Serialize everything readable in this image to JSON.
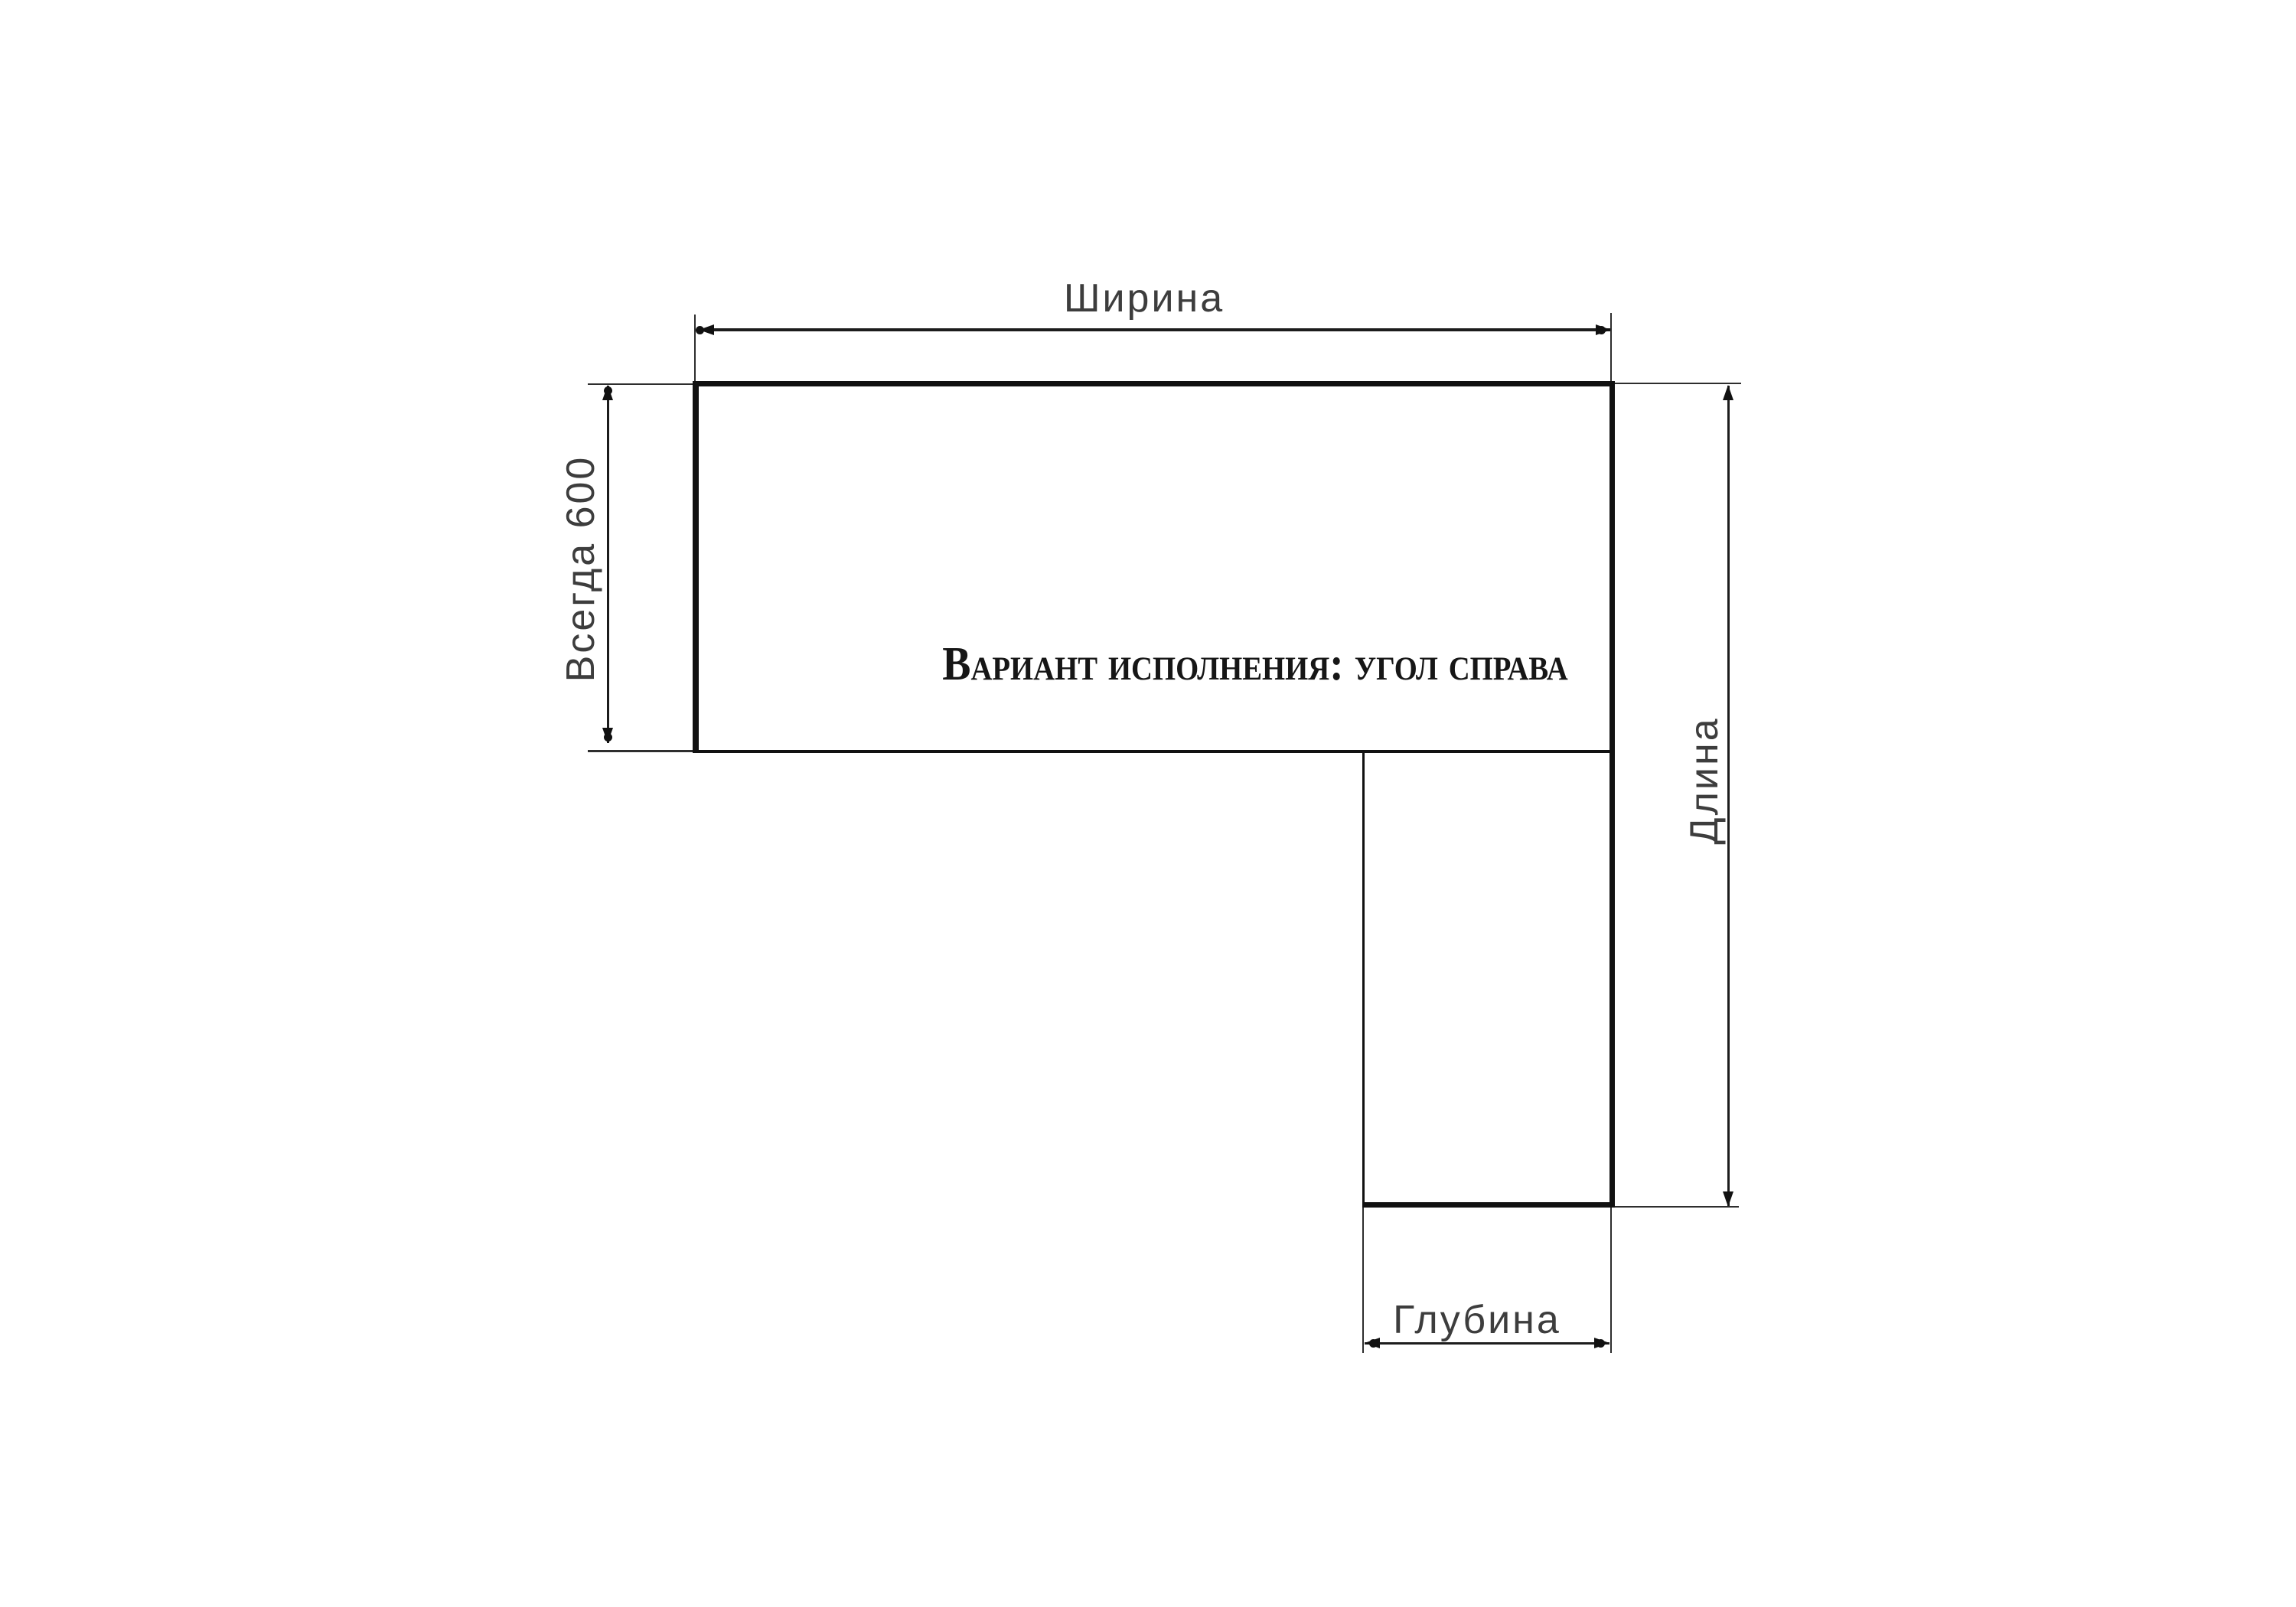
{
  "diagram": {
    "variant_title": "Вариант исполнения: угол справа",
    "dimensions": {
      "width_label": "Ширина",
      "left_label": "Всегда 600",
      "length_label": "Длина",
      "depth_label": "Глубина"
    },
    "colors": {
      "outline": "#111111",
      "dimension_line": "#1c1c1c",
      "extension_line": "#2e2e2e",
      "dim_label_text": "#3d3d3d",
      "title_text": "#161616",
      "background": "#ffffff"
    }
  }
}
